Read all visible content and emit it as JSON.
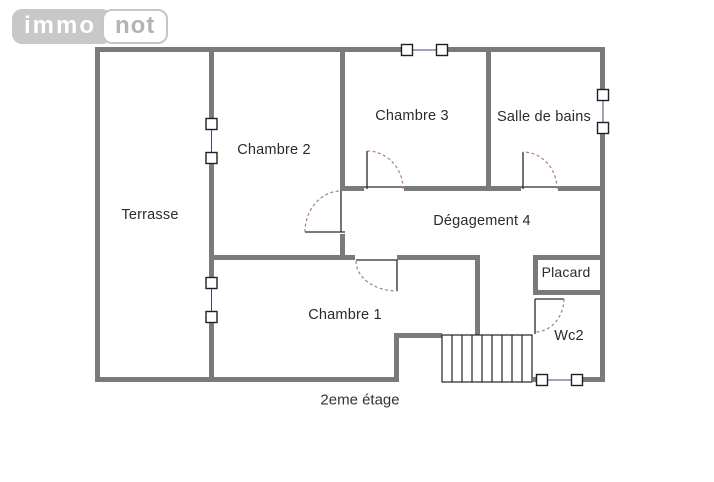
{
  "logo": {
    "immo": "immo",
    "not": "not"
  },
  "plan": {
    "floor_label": "2eme étage",
    "rooms": [
      {
        "name": "Terrasse"
      },
      {
        "name": "Chambre 2"
      },
      {
        "name": "Chambre 3"
      },
      {
        "name": "Salle de bains"
      },
      {
        "name": "Dégagement 4"
      },
      {
        "name": "Placard"
      },
      {
        "name": "Chambre 1"
      },
      {
        "name": "Wc2"
      }
    ]
  },
  "colors": {
    "wall": "#7a7a7a",
    "door_line": "#2a2a2a",
    "door_arc": "#ab7f7f",
    "window_connector": "#44447a",
    "text": "#2b2b2b",
    "logo_pill": "#c8c8c8",
    "logo_text": "#b3b3b3"
  }
}
